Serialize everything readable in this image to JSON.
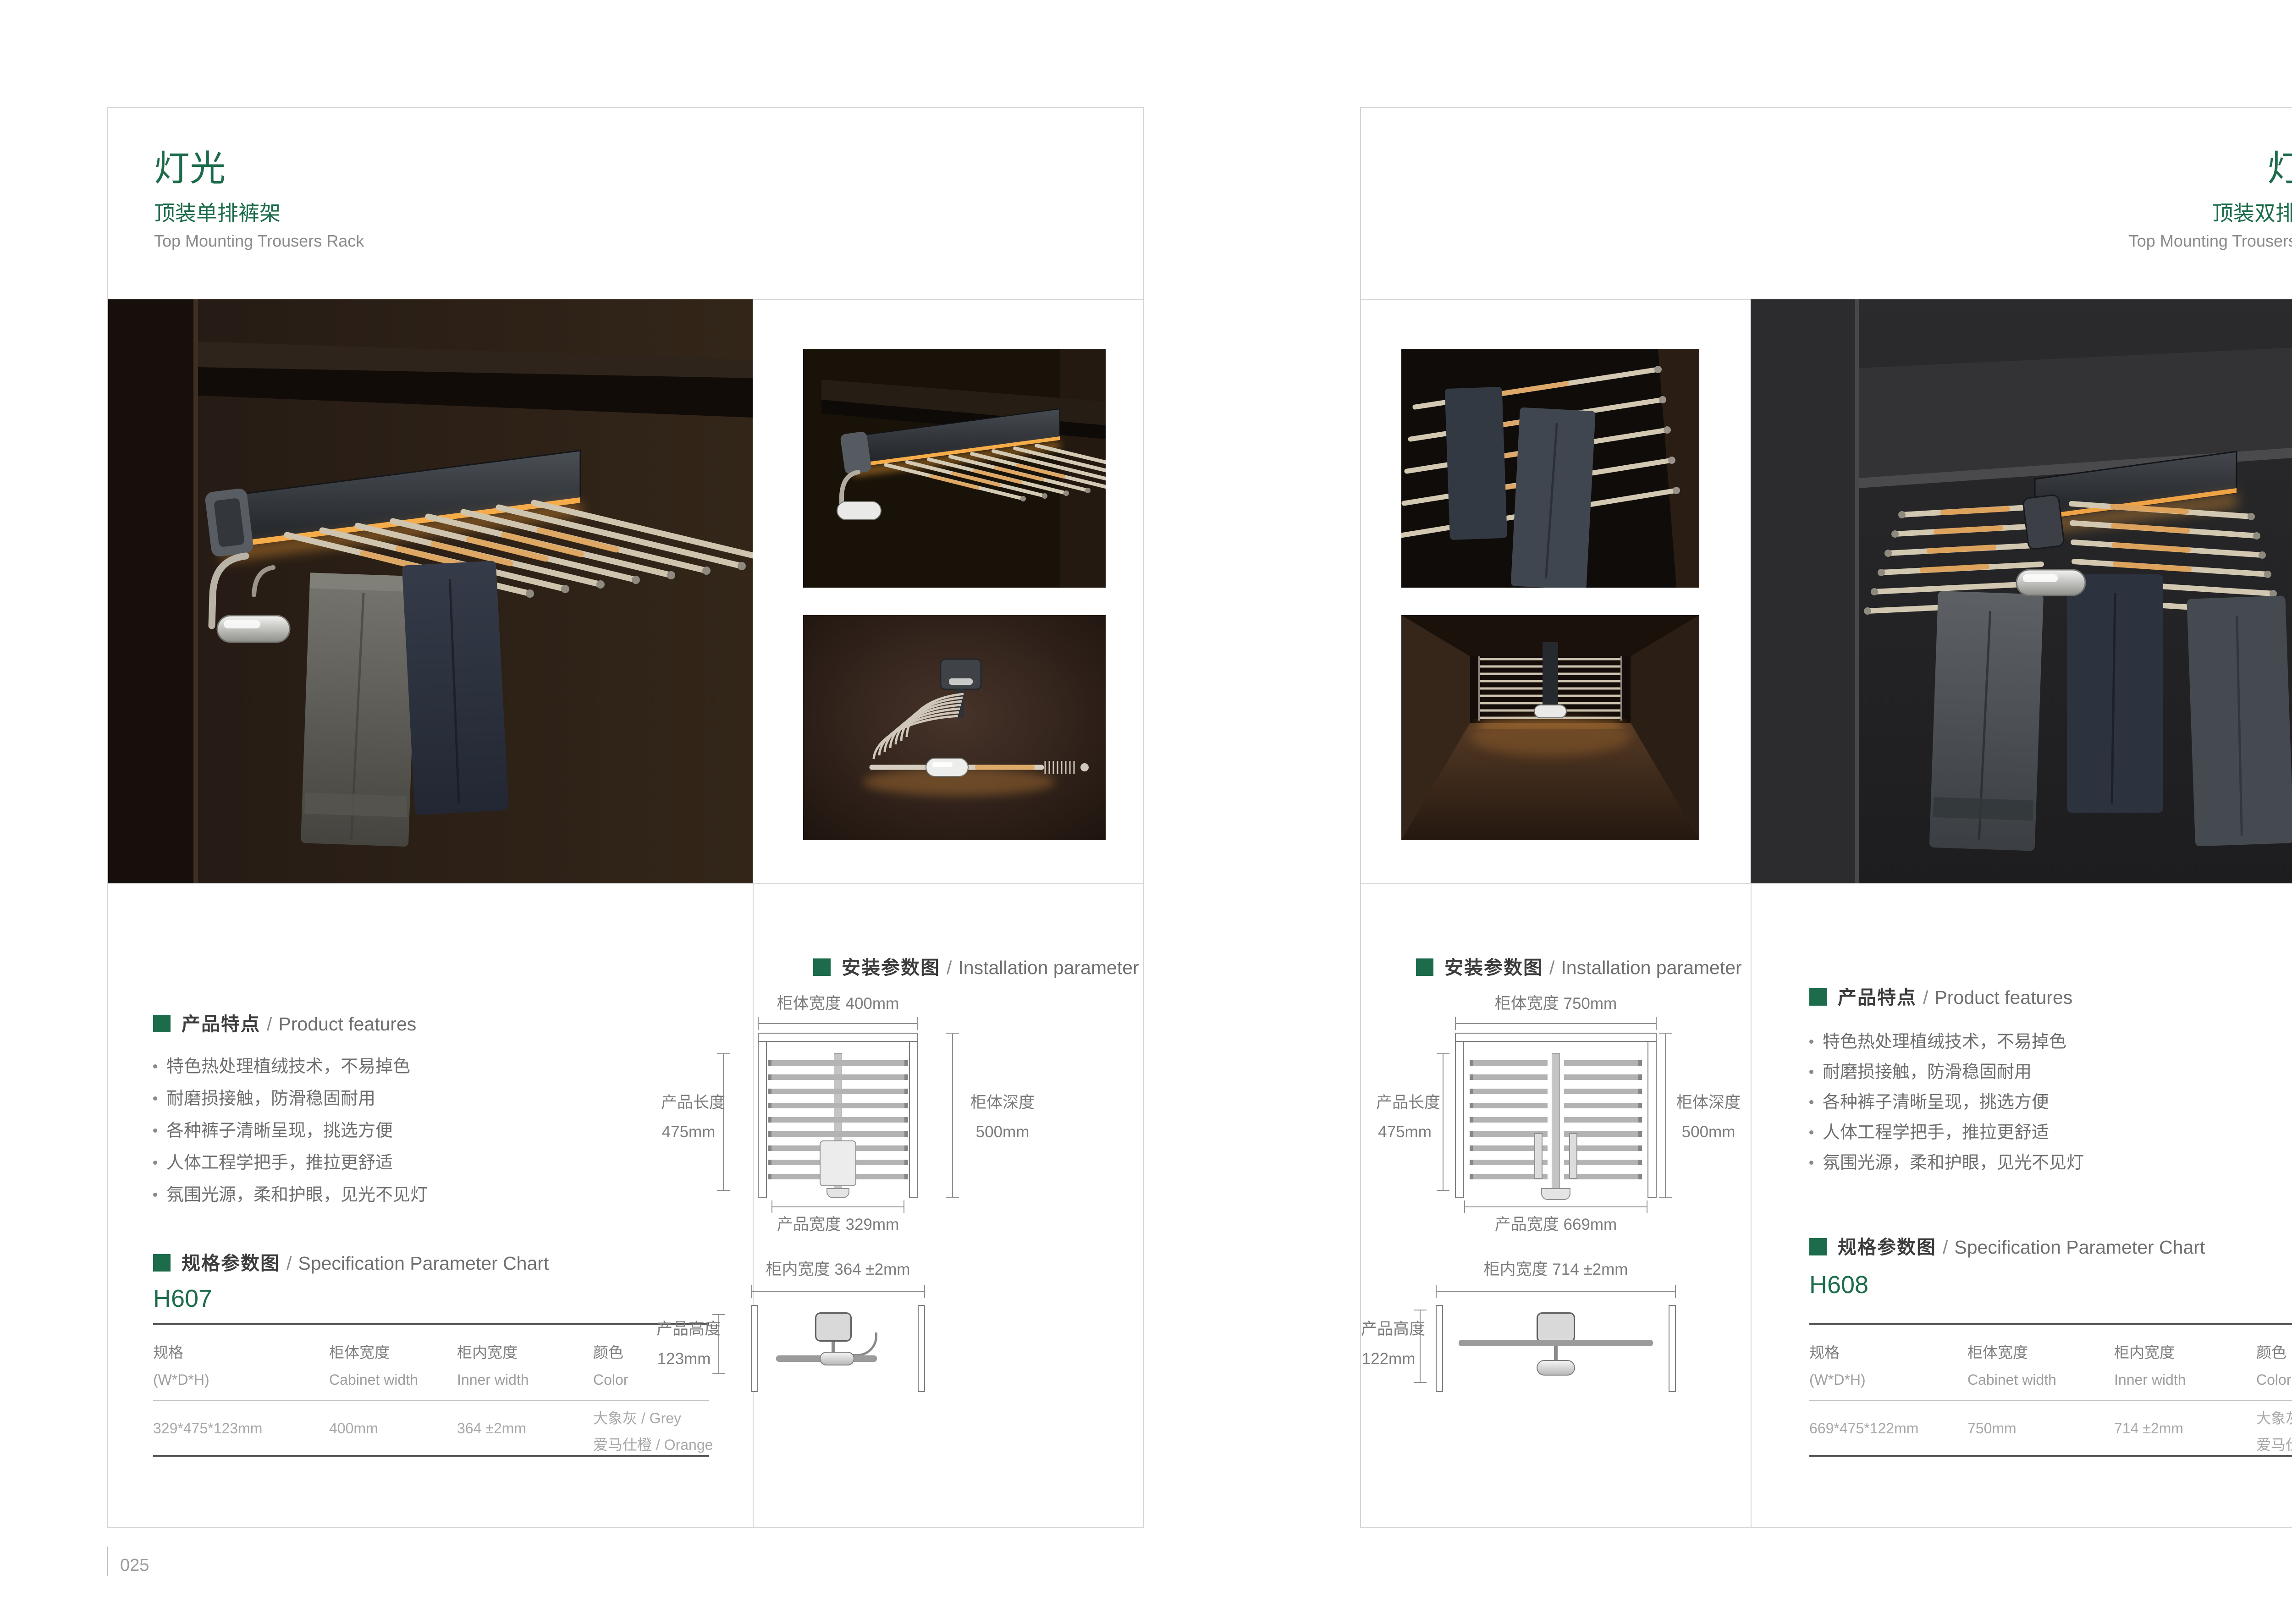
{
  "colors": {
    "accent_green": "#1c6b4a",
    "text_dark": "#3c3c3c",
    "text_gray": "#8a8a8a",
    "led_orange": "#f0a344"
  },
  "shared": {
    "features_title": {
      "zh": "产品特点",
      "sep": "/",
      "en": "Product features"
    },
    "features": [
      "特色热处理植绒技术，不易掉色",
      "耐磨损接触，防滑稳固耐用",
      "各种裤子清晰呈现，挑选方便",
      "人体工程学把手，推拉更舒适",
      "氛围光源，柔和护眼，见光不见灯"
    ],
    "install_title": {
      "zh": "安装参数图",
      "sep": "/",
      "en": "Installation parameter"
    },
    "spec_title": {
      "zh": "规格参数图",
      "sep": "/",
      "en": "Specification Parameter Chart"
    },
    "table": {
      "col1_zh": "规格",
      "col1_en": "(W*D*H)",
      "col2_zh": "柜体宽度",
      "col2_en": "Cabinet width",
      "col3_zh": "柜内宽度",
      "col3_en": "Inner width",
      "col4_zh": "颜色",
      "col4_en": "Color"
    }
  },
  "left_page": {
    "title": "灯光",
    "subtitle": "顶装单排裤架",
    "subtitle_en": "Top Mounting Trousers Rack",
    "model": "H607",
    "row": {
      "size": "329*475*123mm",
      "cabinet": "400mm",
      "inner": "364 ±2mm",
      "color1": "大象灰 / Grey",
      "color2": "爱马仕橙 / Orange"
    },
    "diagram": {
      "cab_w": "柜体宽度 400mm",
      "prod_len_zh": "产品长度",
      "prod_len_val": "475mm",
      "cab_d_zh": "柜体深度",
      "cab_d_val": "500mm",
      "prod_w": "产品宽度 329mm",
      "inner_w": "柜内宽度 364 ±2mm",
      "prod_h_zh": "产品高度",
      "prod_h_val": "123mm"
    },
    "page_no": "025"
  },
  "right_page": {
    "title": "灯光",
    "subtitle": "顶装双排裤架",
    "subtitle_en": "Top Mounting Trousers Rack",
    "model": "H608",
    "row": {
      "size": "669*475*122mm",
      "cabinet": "750mm",
      "inner": "714 ±2mm",
      "color1": "大象灰 / Grey",
      "color2": "爱马仕橙 / Orange"
    },
    "diagram": {
      "cab_w": "柜体宽度 750mm",
      "prod_len_zh": "产品长度",
      "prod_len_val": "475mm",
      "cab_d_zh": "柜体深度",
      "cab_d_val": "500mm",
      "prod_w": "产品宽度 669mm",
      "inner_w": "柜内宽度 714 ±2mm",
      "prod_h_zh": "产品高度",
      "prod_h_val": "122mm"
    },
    "page_no": "026"
  }
}
